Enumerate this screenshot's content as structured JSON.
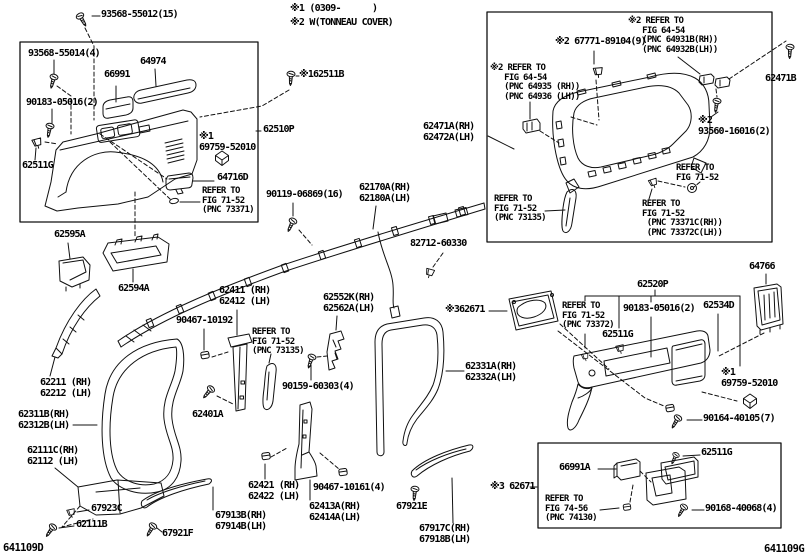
{
  "notes": {
    "line1": "※1 (0309-      )",
    "line2": "※2 W(TONNEAU COVER)"
  },
  "figure_codes": {
    "left": "641109D",
    "right": "641109G"
  },
  "labels": [
    {
      "id": "93568-55012",
      "x": 101,
      "y": 10,
      "s": "b",
      "lines": [
        "93568-55012(15)"
      ]
    },
    {
      "id": "62511B",
      "x": 299,
      "y": 70,
      "s": "b",
      "lines": [
        "※162511B"
      ]
    },
    {
      "id": "93568-55014",
      "x": 28,
      "y": 49,
      "s": "b",
      "lines": [
        "93568-55014(4)"
      ]
    },
    {
      "id": "66991",
      "x": 104,
      "y": 70,
      "s": "b",
      "lines": [
        "66991"
      ]
    },
    {
      "id": "64974",
      "x": 140,
      "y": 57,
      "s": "b",
      "lines": [
        "64974"
      ]
    },
    {
      "id": "90183-05016-left",
      "x": 26,
      "y": 98,
      "s": "b",
      "lines": [
        "90183-05016(2)"
      ]
    },
    {
      "id": "62511G-left",
      "x": 22,
      "y": 161,
      "s": "b",
      "lines": [
        "62511G"
      ]
    },
    {
      "id": "62510P",
      "x": 263,
      "y": 125,
      "s": "b",
      "lines": [
        "62510P"
      ]
    },
    {
      "id": "69759-52010-left",
      "x": 199,
      "y": 132,
      "s": "b",
      "lines": [
        "※1",
        "69759-52010"
      ]
    },
    {
      "id": "64716D",
      "x": 217,
      "y": 173,
      "s": "b",
      "lines": [
        "64716D"
      ]
    },
    {
      "id": "refer-73371",
      "x": 202,
      "y": 187,
      "s": "s",
      "lines": [
        "REFER TO",
        "FIG 71-52",
        "(PNC 73371)"
      ]
    },
    {
      "id": "62595A",
      "x": 54,
      "y": 230,
      "s": "b",
      "lines": [
        "62595A"
      ]
    },
    {
      "id": "62594A",
      "x": 118,
      "y": 284,
      "s": "b",
      "lines": [
        "62594A"
      ]
    },
    {
      "id": "90119-06869",
      "x": 266,
      "y": 190,
      "s": "b",
      "lines": [
        "90119-06869(16)"
      ]
    },
    {
      "id": "62170A",
      "x": 359,
      "y": 183,
      "s": "b",
      "lines": [
        "62170A(RH)",
        "62180A(LH)"
      ]
    },
    {
      "id": "82712-60330",
      "x": 410,
      "y": 239,
      "s": "b",
      "lines": [
        "82712-60330"
      ]
    },
    {
      "id": "62411",
      "x": 219,
      "y": 286,
      "s": "b",
      "lines": [
        "62411 (RH)",
        "62412 (LH)"
      ]
    },
    {
      "id": "90467-10192",
      "x": 176,
      "y": 316,
      "s": "b",
      "lines": [
        "90467-10192"
      ]
    },
    {
      "id": "refer-73135-center",
      "x": 252,
      "y": 328,
      "s": "s",
      "lines": [
        "REFER TO",
        "FIG 71-52",
        "(PNC 73135)"
      ]
    },
    {
      "id": "62552K",
      "x": 323,
      "y": 293,
      "s": "b",
      "lines": [
        "62552K(RH)",
        "62562A(LH)"
      ]
    },
    {
      "id": "90159-60303",
      "x": 282,
      "y": 382,
      "s": "b",
      "lines": [
        "90159-60303(4)"
      ]
    },
    {
      "id": "62401A",
      "x": 192,
      "y": 410,
      "s": "b",
      "lines": [
        "62401A"
      ]
    },
    {
      "id": "62211",
      "x": 40,
      "y": 378,
      "s": "b",
      "lines": [
        "62211 (RH)",
        "62212 (LH)"
      ]
    },
    {
      "id": "62311B",
      "x": 18,
      "y": 410,
      "s": "b",
      "lines": [
        "62311B(RH)",
        "62312B(LH)"
      ]
    },
    {
      "id": "62111C",
      "x": 27,
      "y": 446,
      "s": "b",
      "lines": [
        "62111C(RH)",
        "62112 (LH)"
      ]
    },
    {
      "id": "67923C",
      "x": 91,
      "y": 504,
      "s": "b",
      "lines": [
        "67923C"
      ]
    },
    {
      "id": "62111B",
      "x": 76,
      "y": 520,
      "s": "b",
      "lines": [
        "62111B"
      ]
    },
    {
      "id": "67921F",
      "x": 162,
      "y": 529,
      "s": "b",
      "lines": [
        "67921F"
      ]
    },
    {
      "id": "67913B",
      "x": 215,
      "y": 511,
      "s": "b",
      "lines": [
        "67913B(RH)",
        "67914B(LH)"
      ]
    },
    {
      "id": "62421",
      "x": 248,
      "y": 481,
      "s": "b",
      "lines": [
        "62421 (RH)",
        "62422 (LH)"
      ]
    },
    {
      "id": "90467-10161",
      "x": 313,
      "y": 483,
      "s": "b",
      "lines": [
        "90467-10161(4)"
      ]
    },
    {
      "id": "62413A",
      "x": 309,
      "y": 502,
      "s": "b",
      "lines": [
        "62413A(RH)",
        "62414A(LH)"
      ]
    },
    {
      "id": "67921E",
      "x": 396,
      "y": 502,
      "s": "b",
      "lines": [
        "67921E"
      ]
    },
    {
      "id": "67917C",
      "x": 419,
      "y": 524,
      "s": "b",
      "lines": [
        "67917C(RH)",
        "67918B(LH)"
      ]
    },
    {
      "id": "62331A",
      "x": 465,
      "y": 362,
      "s": "b",
      "lines": [
        "62331A(RH)",
        "62332A(LH)"
      ]
    },
    {
      "id": "62671-upper",
      "x": 445,
      "y": 305,
      "s": "b",
      "lines": [
        "※362671"
      ]
    },
    {
      "id": "refer-73372",
      "x": 562,
      "y": 302,
      "s": "s",
      "lines": [
        "REFER TO",
        "FIG 71-52",
        "(PNC 73372)"
      ]
    },
    {
      "id": "62511G-mid",
      "x": 602,
      "y": 330,
      "s": "b",
      "lines": [
        "62511G"
      ]
    },
    {
      "id": "62520P",
      "x": 637,
      "y": 280,
      "s": "b",
      "lines": [
        "62520P"
      ]
    },
    {
      "id": "90183-05016-right",
      "x": 623,
      "y": 304,
      "s": "b",
      "lines": [
        "90183-05016(2)"
      ]
    },
    {
      "id": "62534D",
      "x": 703,
      "y": 301,
      "s": "b",
      "lines": [
        "62534D"
      ]
    },
    {
      "id": "64766",
      "x": 749,
      "y": 262,
      "s": "b",
      "lines": [
        "64766"
      ]
    },
    {
      "id": "69759-52010-right",
      "x": 721,
      "y": 368,
      "s": "b",
      "lines": [
        "※1",
        "69759-52010"
      ]
    },
    {
      "id": "90164-40105",
      "x": 703,
      "y": 414,
      "s": "b",
      "lines": [
        "90164-40105(7)"
      ]
    },
    {
      "id": "62511G-bottom",
      "x": 701,
      "y": 448,
      "s": "b",
      "lines": [
        "62511G"
      ]
    },
    {
      "id": "66991A",
      "x": 559,
      "y": 463,
      "s": "b",
      "lines": [
        "66991A"
      ]
    },
    {
      "id": "refer-74130",
      "x": 545,
      "y": 495,
      "s": "s",
      "lines": [
        "REFER TO",
        "FIG 74-56",
        "(PNC 74130)"
      ]
    },
    {
      "id": "90168-40068",
      "x": 705,
      "y": 504,
      "s": "b",
      "lines": [
        "90168-40068(4)"
      ]
    },
    {
      "id": "62671-lower",
      "x": 490,
      "y": 482,
      "s": "b",
      "lines": [
        "※3 62671"
      ]
    },
    {
      "id": "refer-64931B",
      "x": 628,
      "y": 17,
      "s": "s",
      "lines": [
        "※2 REFER TO",
        "   FIG 64-54",
        "   (PNC 64931B(RH))",
        "   (PNC 64932B(LH))"
      ]
    },
    {
      "id": "67771-89104",
      "x": 555,
      "y": 37,
      "s": "b",
      "lines": [
        "※2 67771-89104(9)"
      ]
    },
    {
      "id": "refer-64935",
      "x": 490,
      "y": 64,
      "s": "s",
      "lines": [
        "※2 REFER TO",
        "   FIG 64-54",
        "   (PNC 64935 (RH))",
        "   (PNC 64936 (LH))"
      ]
    },
    {
      "id": "62471A",
      "x": 423,
      "y": 122,
      "s": "b",
      "lines": [
        "62471A(RH)",
        "62472A(LH)"
      ]
    },
    {
      "id": "93560-16016",
      "x": 698,
      "y": 116,
      "s": "b",
      "lines": [
        "※2",
        "93560-16016(2)"
      ]
    },
    {
      "id": "62471B",
      "x": 765,
      "y": 74,
      "s": "b",
      "lines": [
        "62471B"
      ]
    },
    {
      "id": "refer-7152-r1",
      "x": 676,
      "y": 164,
      "s": "s",
      "lines": [
        "REFER TO",
        "FIG 71-52"
      ]
    },
    {
      "id": "refer-7152-r2",
      "x": 642,
      "y": 200,
      "s": "s",
      "lines": [
        "REFER TO",
        "FIG 71-52",
        " (PNC 73371C(RH))",
        " (PNC 73372C(LH))"
      ]
    },
    {
      "id": "refer-73135-box",
      "x": 494,
      "y": 195,
      "s": "s",
      "lines": [
        "REFER TO",
        "FIG 71-52",
        "(PNC 73135)"
      ]
    }
  ]
}
